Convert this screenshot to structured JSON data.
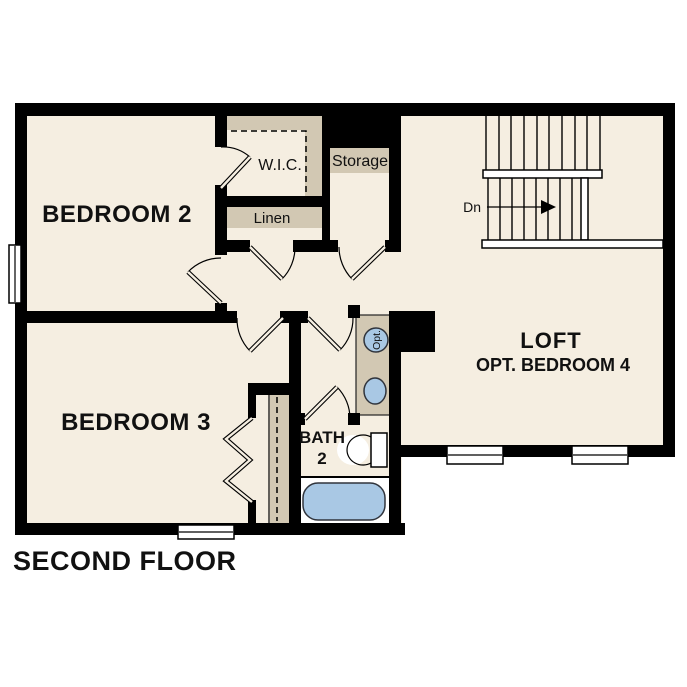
{
  "title": {
    "text": "SECOND FLOOR"
  },
  "colors": {
    "background": "#ffffff",
    "floor": "#f5eee1",
    "cabinet": "#d2c8b3",
    "fixture": "#a9c8e4",
    "wall": "#000000",
    "ink": "#111111"
  },
  "rooms": {
    "bedroom2": {
      "label": "BEDROOM 2"
    },
    "bedroom3": {
      "label": "BEDROOM 3"
    },
    "loft": {
      "label": "LOFT",
      "sublabel": "OPT. BEDROOM 4"
    },
    "bath": {
      "label_line1": "BATH",
      "label_line2": "2"
    }
  },
  "closets": {
    "wic": {
      "label": "W.I.C."
    },
    "linen": {
      "label": "Linen"
    },
    "storage": {
      "label": "Storage"
    }
  },
  "stairs": {
    "down_label": "Dn"
  },
  "fixtures": {
    "optional_sink_label": "Opt."
  }
}
